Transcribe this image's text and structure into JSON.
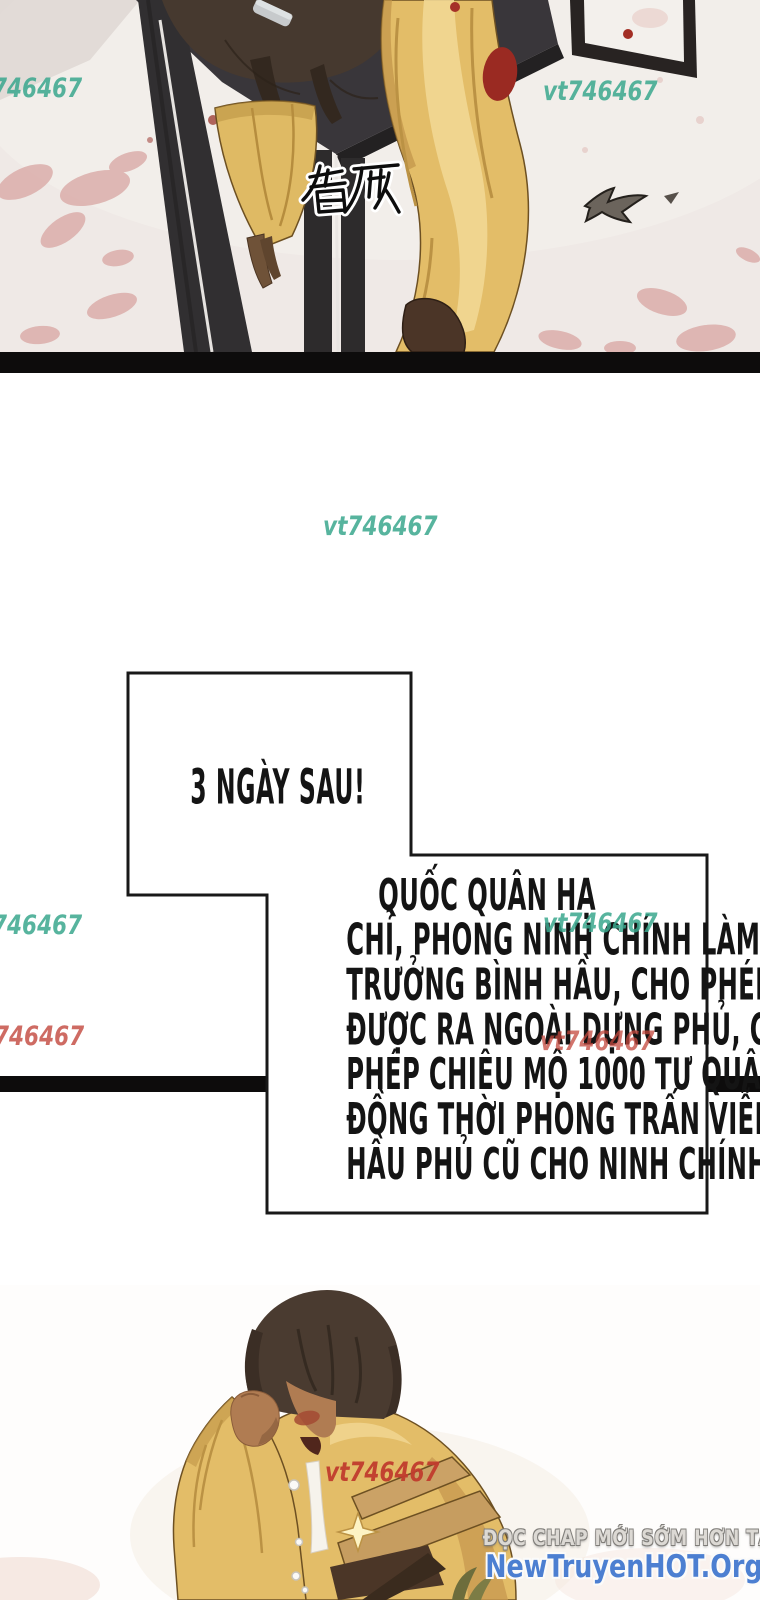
{
  "page": {
    "width": 760,
    "height": 1600,
    "background": "#ffffff"
  },
  "colors": {
    "watermark_teal": "#3aa78e",
    "watermark_red": "#c3473d",
    "separator_bar": "#0d0c0c",
    "balloon_border": "#181818",
    "balloon_fill": "#ffffff",
    "balloon_text": "#141414",
    "robe_yellow": "#e3bd68",
    "footer_line1_color": "#dcd9d4",
    "footer_line2_color": "#4c7fd1"
  },
  "top_panel": {
    "sfx": "昏厥"
  },
  "watermarks": {
    "top_left": "746467",
    "top_right": "vt746467",
    "middle": "vt746467",
    "mid_left": "746467",
    "mid_right": "vt746467",
    "low_left": "746467",
    "low_center": "vt746467",
    "bottom": "vt746467"
  },
  "balloon": {
    "box1": "3 NGÀY SAU!",
    "box2_lines": [
      "QUỐC QUÂN HẠ",
      "CHỈ, PHONG NINH CHÍNH LÀM",
      "TRƯỞNG BÌNH HẦU, CHO PHÉP",
      "ĐƯỢC RA NGOÀI DỰNG PHỦ, CHO",
      "PHÉP CHIÊU MỘ 1000 TƯ QUÂN,",
      "ĐỒNG THỜI PHONG TRẤN VIỄN",
      "HẦU PHỦ CŨ CHO NINH CHÍNH."
    ]
  },
  "footer": {
    "line1": "ĐỌC CHAP MỚI SỚM HƠN TẠI",
    "line2": "NewTruyenHOT.Org"
  }
}
